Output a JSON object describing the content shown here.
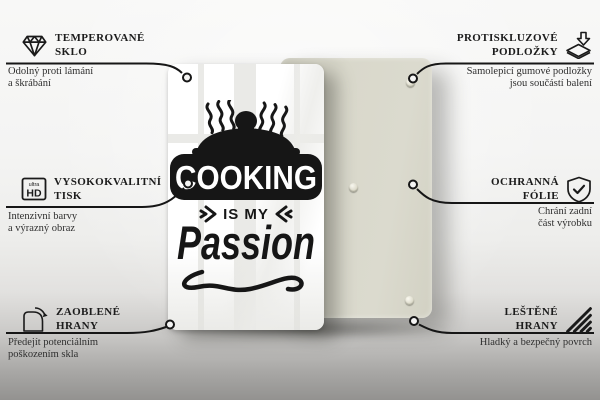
{
  "image_type": "product-infographic",
  "product": {
    "artwork": {
      "line1": "COOKING",
      "line2": "IS MY",
      "line3": "Passion"
    },
    "icon_hd_top": "ultra",
    "icon_hd_bottom": "HD",
    "back_panel_color": "#d9d8cb",
    "glass_color": "#ffffff",
    "line_color": "#161616",
    "pads_visible": 3
  },
  "features": [
    {
      "id": "tempered-glass",
      "icon": "diamond-icon",
      "title_line1": "TEMPEROVANÉ",
      "title_line2": "SKLO",
      "sub_line1": "Odolný proti lámání",
      "sub_line2": "a škrábání"
    },
    {
      "id": "anti-slip-pads",
      "icon": "anti-slip-pad-icon",
      "title_line1": "PROTISKLUZOVÉ",
      "title_line2": "PODLOŽKY",
      "sub_line1": "Samolepicí gumové podložky",
      "sub_line2": "jsou součástí balení"
    },
    {
      "id": "high-quality-print",
      "icon": "ultra-hd-icon",
      "title_line1": "VYSOKOKVALITNÍ",
      "title_line2": "TISK",
      "sub_line1": "Intenzivní barvy",
      "sub_line2": "a výrazný obraz"
    },
    {
      "id": "protective-foil",
      "icon": "shield-check-icon",
      "title_line1": "OCHRANNÁ",
      "title_line2": "FÓLIE",
      "sub_line1": "Chrání zadní",
      "sub_line2": "část výrobku"
    },
    {
      "id": "rounded-edges",
      "icon": "rounded-corner-icon",
      "title_line1": "ZAOBLENÉ",
      "title_line2": "HRANY",
      "sub_line1": "Předejít potenciálním",
      "sub_line2": "poškozením skla"
    },
    {
      "id": "polished-edges",
      "icon": "polished-edge-icon",
      "title_line1": "LEŠTĚNÉ",
      "title_line2": "HRANY",
      "sub_line1": "Hladký a bezpečný povrch",
      "sub_line2": ""
    }
  ]
}
